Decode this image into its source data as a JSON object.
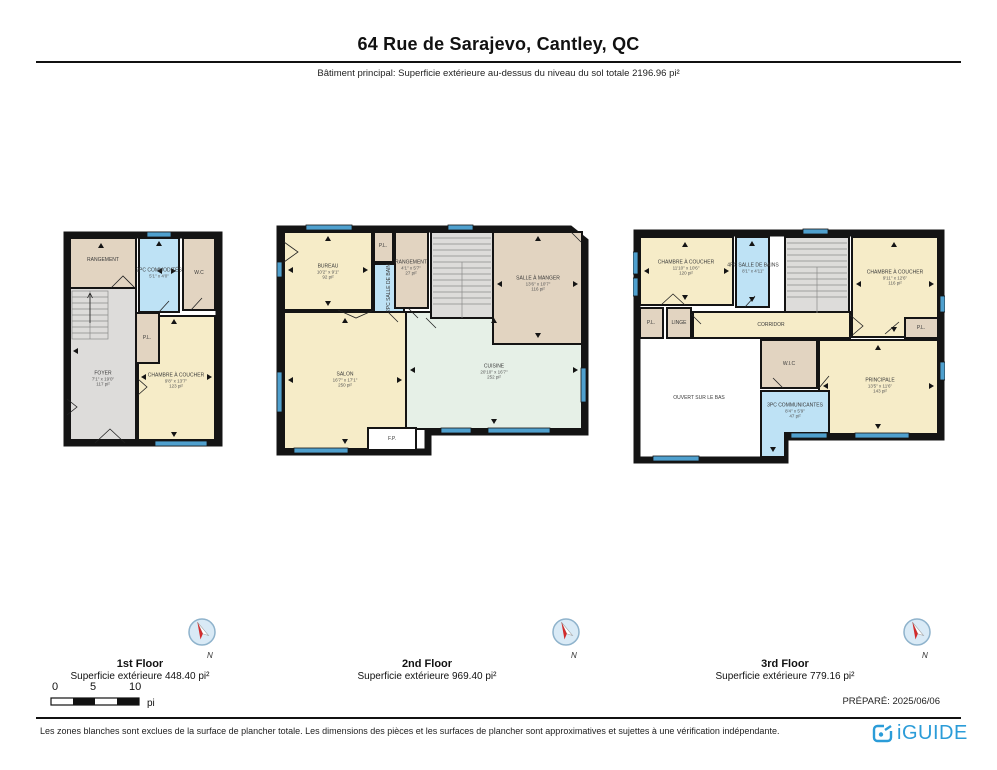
{
  "title": "64 Rue de Sarajevo, Cantley, QC",
  "subtitle": "Bâtiment principal: Superficie extérieure au-dessus du niveau du sol totale 2196.96 pi²",
  "compass": {
    "label": "N"
  },
  "scalebar": {
    "zero": "0",
    "five": "5",
    "ten": "10",
    "unit": "pi"
  },
  "prepared": "PRÉPARÉ: 2025/06/06",
  "disclaimer": "Les zones blanches sont exclues de la surface de plancher totale. Les dimensions des pièces et les surfaces de plancher sont approximatives et sujettes à une vérification indépendante.",
  "brand": {
    "name": "iGUIDE"
  },
  "colors": {
    "wall": "#141414",
    "room_cream": "#F6ECC8",
    "room_tan": "#E2D4C1",
    "room_blue": "#BEE2F5",
    "room_gray": "#DDDCDA",
    "room_green": "#E6F0E7",
    "window_blue": "#4FA0CE",
    "brand_blue": "#2B9CD8"
  },
  "floor1": {
    "caption": "1st Floor",
    "area": "Superficie extérieure 448.40 pi²",
    "rooms": {
      "rangement": {
        "name": "RANGEMENT"
      },
      "powder": {
        "name": "2PC COMMODITÉS",
        "dims": "5'1\" x 4'0\""
      },
      "wc": {
        "name": "W.C"
      },
      "foyer": {
        "name": "FOYER",
        "dims": "7'1\" x 19'0\"",
        "area": "117 pi²"
      },
      "pl": {
        "name": "P.L."
      },
      "chambre": {
        "name": "CHAMBRE À COUCHER",
        "dims": "9'8\" x 13'7\"",
        "area": "123 pi²"
      }
    }
  },
  "floor2": {
    "caption": "2nd Floor",
    "area": "Superficie extérieure 969.40 pi²",
    "rooms": {
      "bureau": {
        "name": "BUREAU",
        "dims": "10'2\" x 9'1\"",
        "area": "92 pi²"
      },
      "pl": {
        "name": "P.L."
      },
      "bain": {
        "name": "2PC SALLE DE BAIN"
      },
      "rangement": {
        "name": "RANGEMENT",
        "dims": "4'1\" x 5'7\"",
        "area": "27 pi²"
      },
      "sallemanger": {
        "name": "SALLE À MANGER",
        "dims": "13'6\" x 10'7\"",
        "area": "116 pi²"
      },
      "salon": {
        "name": "SALON",
        "dims": "16'7\" x 17'1\"",
        "area": "250 pi²"
      },
      "cuisine": {
        "name": "CUISINE",
        "dims": "20'10\" x 16'7\"",
        "area": "252 pi²"
      },
      "fp": {
        "name": "F.P."
      }
    }
  },
  "floor3": {
    "caption": "3rd Floor",
    "area": "Superficie extérieure 779.16 pi²",
    "rooms": {
      "chambre1": {
        "name": "CHAMBRE À COUCHER",
        "dims": "11'10\" x 10'6\"",
        "area": "120 pi²"
      },
      "bain4": {
        "name": "4PC SALLE DE BAINS",
        "dims": "8'1\" x 4'11\""
      },
      "chambre2": {
        "name": "CHAMBRE À COUCHER",
        "dims": "9'11\" x 12'6\"",
        "area": "116 pi²"
      },
      "pl_left": {
        "name": "P.L."
      },
      "linge": {
        "name": "LINGE"
      },
      "corridor": {
        "name": "CORRIDOR"
      },
      "pl_right": {
        "name": "P.L."
      },
      "ouvert": {
        "name": "OUVERT SUR LE BAS"
      },
      "wic": {
        "name": "W.I.C"
      },
      "ensuite": {
        "name": "3PC COMMUNICANTES",
        "dims": "8'4\" x 5'9\"",
        "area": "47 pi²"
      },
      "principale": {
        "name": "PRINCIPALE",
        "dims": "13'5\" x 11'6\"",
        "area": "143 pi²"
      }
    }
  }
}
